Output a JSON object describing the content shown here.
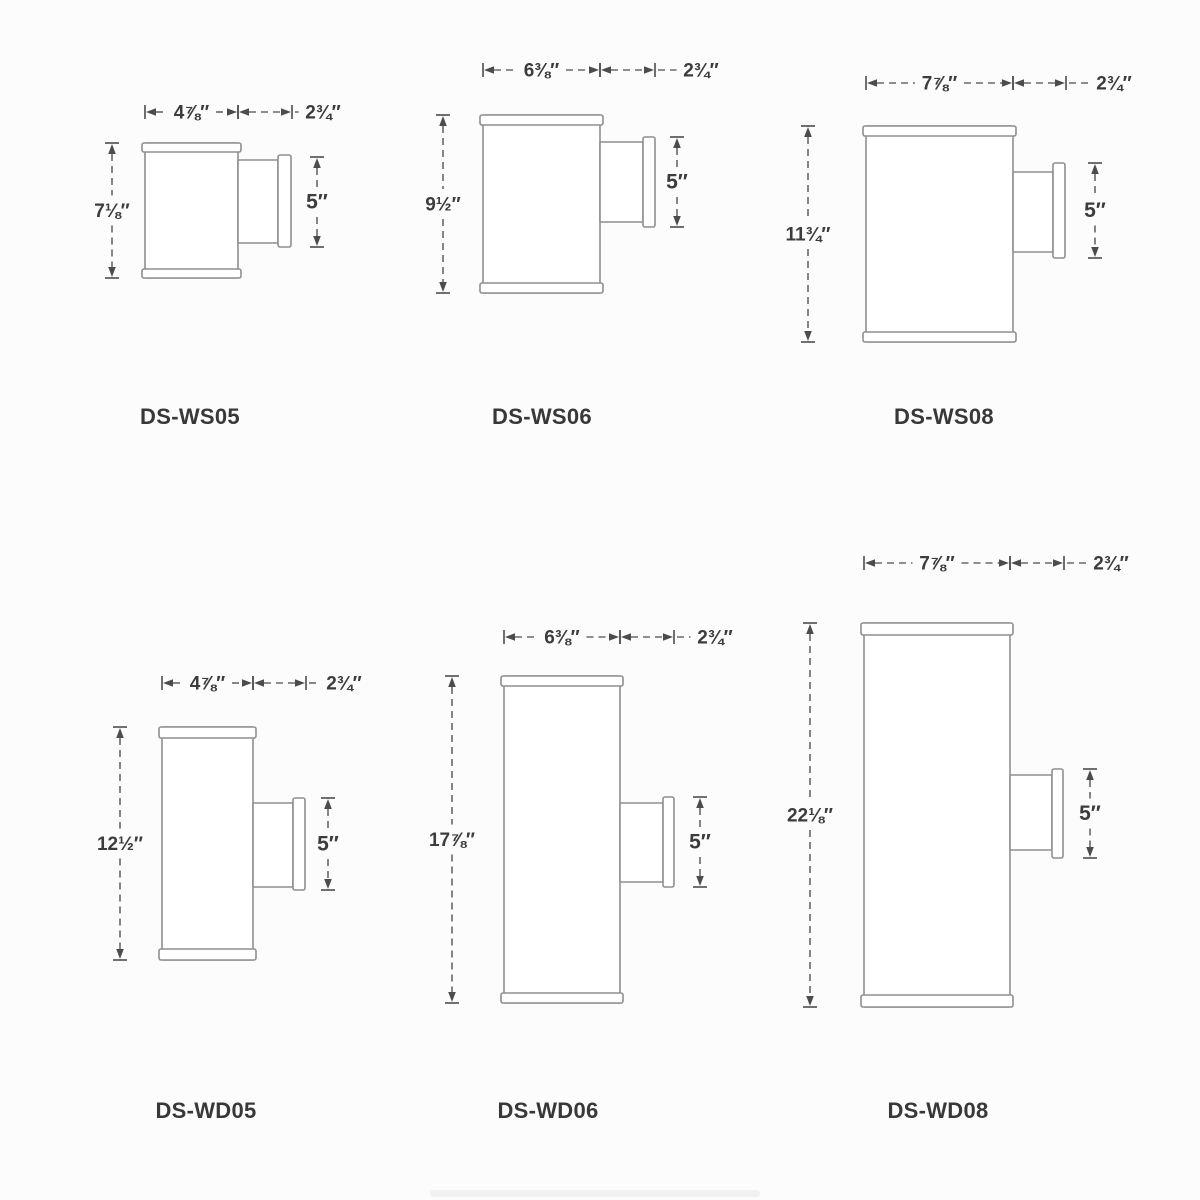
{
  "page": {
    "type": "product-dimension-drawing",
    "background": "#fcfcfc",
    "line_color": "#8f8f8f",
    "dimension_color": "#4c4c4c",
    "text_color": "#3c3c3c"
  },
  "fixtures": [
    {
      "model": "DS-WS05",
      "dimensions": {
        "width": "4⅞″",
        "extension": "2¾″",
        "height": "7⅛″",
        "backplate": "5″"
      },
      "geometry": {
        "body": {
          "x": 145,
          "y": 143,
          "w": 93,
          "h": 135,
          "cap": 9
        },
        "arm": {
          "x": 238,
          "y": 160,
          "w": 40,
          "h": 83
        },
        "plate": {
          "x": 278,
          "y": 155,
          "w": 13,
          "h": 92
        },
        "dim_width": {
          "label": "4⅞″",
          "x1": 145,
          "x2": 238,
          "y": 112
        },
        "dim_depth": {
          "label": "2¾″",
          "x1": 238,
          "x2": 292,
          "y": 112,
          "label_x": 323
        },
        "dim_height": {
          "label": "7⅛″",
          "x": 112,
          "y1": 143,
          "y2": 278
        },
        "dim_side": {
          "label": "5″",
          "x": 317,
          "y1": 157,
          "y2": 247
        },
        "label": {
          "x": 190,
          "y": 424
        }
      }
    },
    {
      "model": "DS-WS06",
      "dimensions": {
        "width": "6⅜″",
        "extension": "2¾″",
        "height": "9½″",
        "backplate": "5″"
      },
      "geometry": {
        "body": {
          "x": 483,
          "y": 115,
          "w": 117,
          "h": 178,
          "cap": 10
        },
        "arm": {
          "x": 600,
          "y": 142,
          "w": 43,
          "h": 80
        },
        "plate": {
          "x": 643,
          "y": 137,
          "w": 12,
          "h": 90
        },
        "dim_width": {
          "label": "6⅜″",
          "x1": 483,
          "x2": 600,
          "y": 70
        },
        "dim_depth": {
          "label": "2¾″",
          "x1": 600,
          "x2": 655,
          "y": 70,
          "label_x": 701
        },
        "dim_height": {
          "label": "9½″",
          "x": 443,
          "y1": 115,
          "y2": 293
        },
        "dim_side": {
          "label": "5″",
          "x": 677,
          "y1": 137,
          "y2": 227
        },
        "label": {
          "x": 542,
          "y": 424
        }
      }
    },
    {
      "model": "DS-WS08",
      "dimensions": {
        "width": "7⅞″",
        "extension": "2¾″",
        "height": "11¾″",
        "backplate": "5″"
      },
      "geometry": {
        "body": {
          "x": 866,
          "y": 126,
          "w": 147,
          "h": 216,
          "cap": 10
        },
        "arm": {
          "x": 1013,
          "y": 172,
          "w": 40,
          "h": 80
        },
        "plate": {
          "x": 1053,
          "y": 163,
          "w": 12,
          "h": 95
        },
        "dim_width": {
          "label": "7⅞″",
          "x1": 866,
          "x2": 1013,
          "y": 83
        },
        "dim_depth": {
          "label": "2¾″",
          "x1": 1013,
          "x2": 1066,
          "y": 83,
          "label_x": 1114
        },
        "dim_height": {
          "label": "11¾″",
          "x": 808,
          "y1": 126,
          "y2": 342
        },
        "dim_side": {
          "label": "5″",
          "x": 1095,
          "y1": 163,
          "y2": 258
        },
        "label": {
          "x": 944,
          "y": 424
        }
      }
    },
    {
      "model": "DS-WD05",
      "dimensions": {
        "width": "4⅞″",
        "extension": "2¾″",
        "height": "12½″",
        "backplate": "5″"
      },
      "geometry": {
        "body": {
          "x": 162,
          "y": 727,
          "w": 91,
          "h": 233,
          "cap": 11
        },
        "arm": {
          "x": 253,
          "y": 803,
          "w": 40,
          "h": 84
        },
        "plate": {
          "x": 293,
          "y": 798,
          "w": 12,
          "h": 92
        },
        "dim_width": {
          "label": "4⅞″",
          "x1": 162,
          "x2": 253,
          "y": 683
        },
        "dim_depth": {
          "label": "2¾″",
          "x1": 253,
          "x2": 306,
          "y": 683,
          "label_x": 344
        },
        "dim_height": {
          "label": "12½″",
          "x": 120,
          "y1": 727,
          "y2": 960
        },
        "dim_side": {
          "label": "5″",
          "x": 328,
          "y1": 798,
          "y2": 890
        },
        "label": {
          "x": 206,
          "y": 1118
        }
      }
    },
    {
      "model": "DS-WD06",
      "dimensions": {
        "width": "6⅜″",
        "extension": "2¾″",
        "height": "17⅞″",
        "backplate": "5″"
      },
      "geometry": {
        "body": {
          "x": 504,
          "y": 676,
          "w": 116,
          "h": 327,
          "cap": 10
        },
        "arm": {
          "x": 620,
          "y": 803,
          "w": 43,
          "h": 79
        },
        "plate": {
          "x": 663,
          "y": 797,
          "w": 11,
          "h": 90
        },
        "dim_width": {
          "label": "6⅜″",
          "x1": 504,
          "x2": 620,
          "y": 637
        },
        "dim_depth": {
          "label": "2¾″",
          "x1": 620,
          "x2": 674,
          "y": 637,
          "label_x": 715
        },
        "dim_height": {
          "label": "17⅞″",
          "x": 452,
          "y1": 676,
          "y2": 1003
        },
        "dim_side": {
          "label": "5″",
          "x": 700,
          "y1": 797,
          "y2": 887
        },
        "label": {
          "x": 548,
          "y": 1118
        }
      }
    },
    {
      "model": "DS-WD08",
      "dimensions": {
        "width": "7⅞″",
        "extension": "2¾″",
        "height": "22⅛″",
        "backplate": "5″"
      },
      "geometry": {
        "body": {
          "x": 864,
          "y": 623,
          "w": 146,
          "h": 384,
          "cap": 12
        },
        "arm": {
          "x": 1010,
          "y": 775,
          "w": 42,
          "h": 75
        },
        "plate": {
          "x": 1052,
          "y": 769,
          "w": 11,
          "h": 89
        },
        "dim_width": {
          "label": "7⅞″",
          "x1": 864,
          "x2": 1010,
          "y": 563
        },
        "dim_depth": {
          "label": "2¾″",
          "x1": 1010,
          "x2": 1064,
          "y": 563,
          "label_x": 1111
        },
        "dim_height": {
          "label": "22⅛″",
          "x": 810,
          "y1": 623,
          "y2": 1007
        },
        "dim_side": {
          "label": "5″",
          "x": 1090,
          "y1": 769,
          "y2": 858
        },
        "label": {
          "x": 938,
          "y": 1118
        }
      }
    }
  ]
}
